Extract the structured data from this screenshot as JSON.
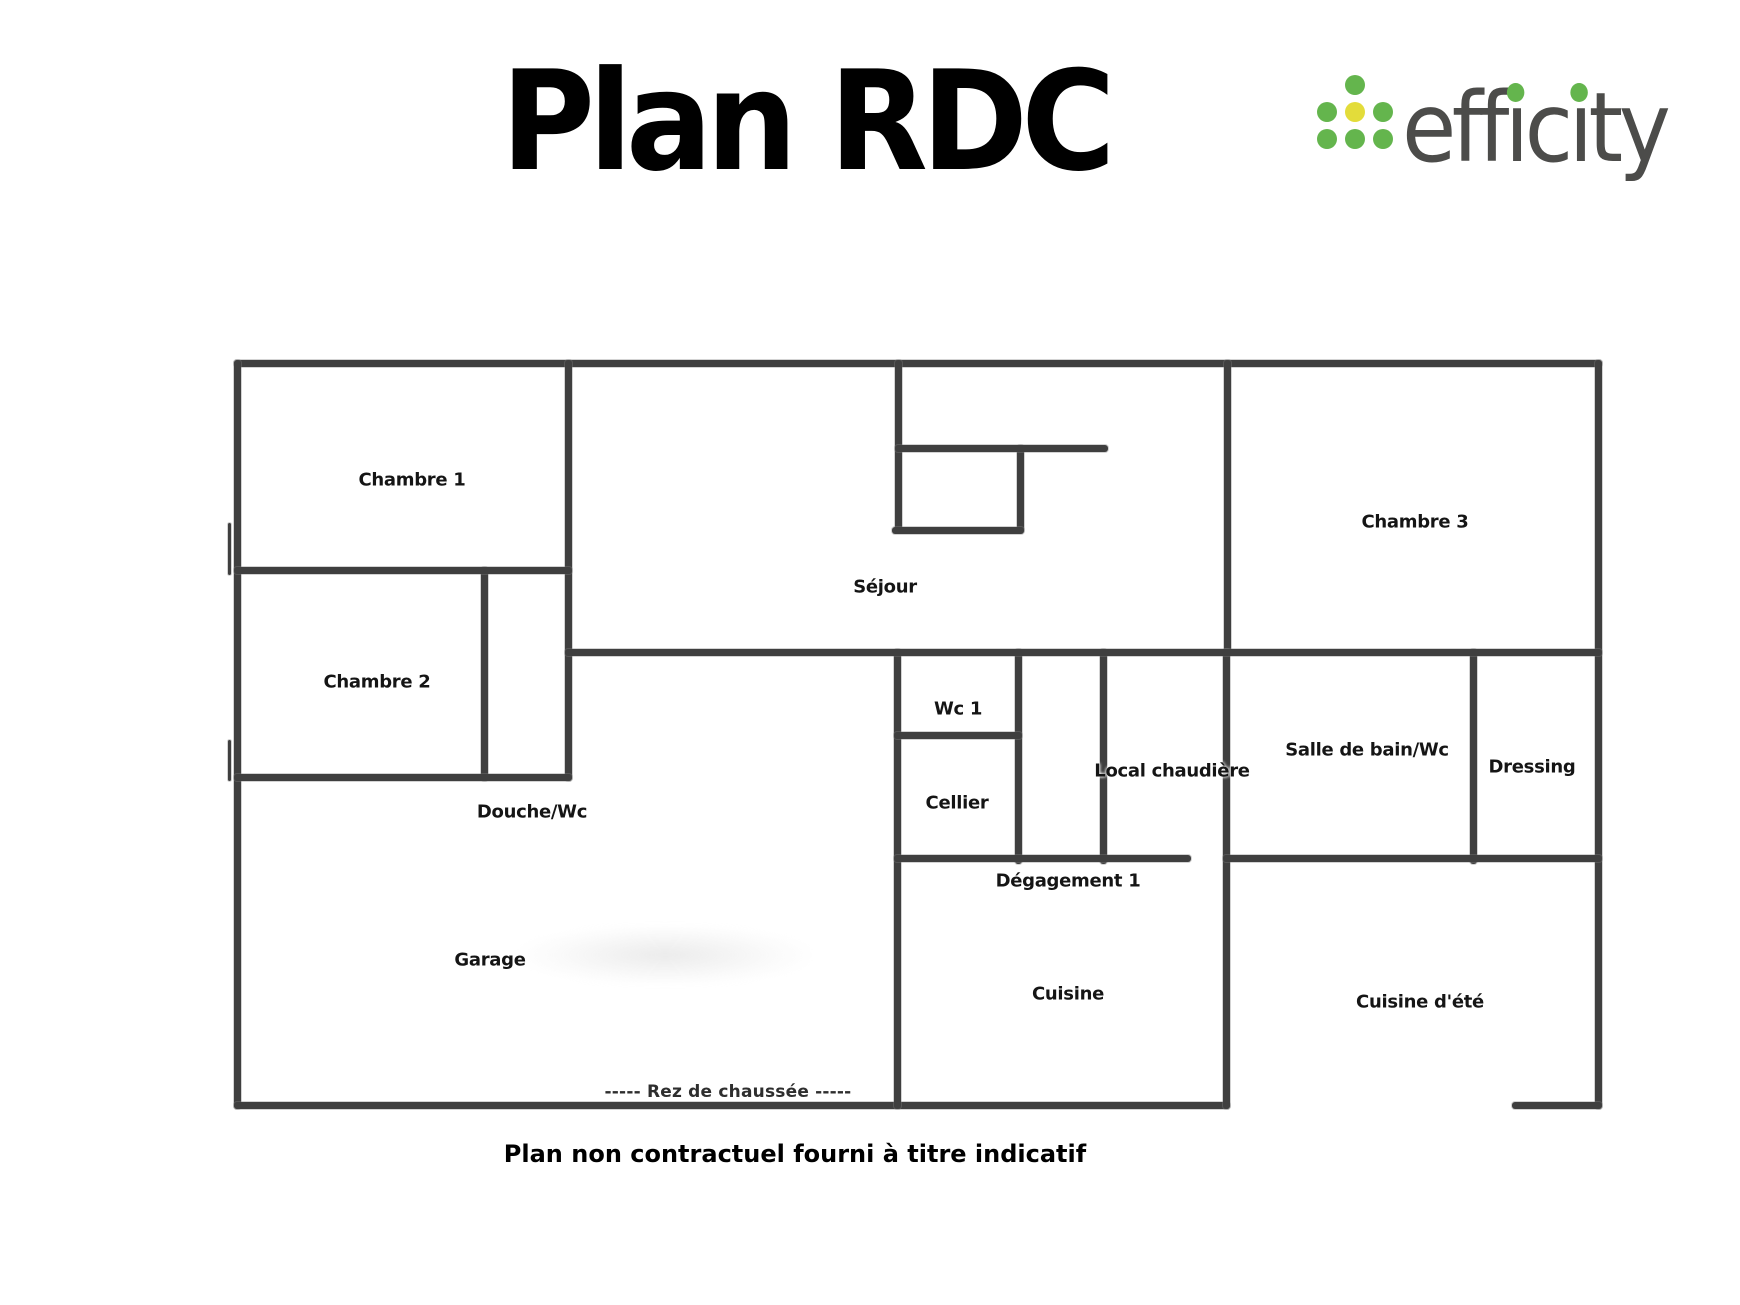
{
  "title": {
    "text": "Plan RDC"
  },
  "logo": {
    "word": "efficity",
    "render_parts": [
      {
        "t": "eff",
        "dot": false
      },
      {
        "t": "ı",
        "dot": true
      },
      {
        "t": "c",
        "dot": false
      },
      {
        "t": "ı",
        "dot": true
      },
      {
        "t": "ty",
        "dot": false
      }
    ],
    "text_color": "#4c4c4a",
    "dot_green": "#64b54d",
    "dot_yellow": "#e3dc3a",
    "pyramid_rows": [
      1,
      3,
      3
    ]
  },
  "floorplan": {
    "wall_color": "#3f3f3f",
    "footer_note": "-----  Rez de chaussée  -----",
    "rooms": [
      {
        "label": "Chambre 1",
        "x": 412,
        "y": 480
      },
      {
        "label": "Chambre 2",
        "x": 377,
        "y": 682
      },
      {
        "label": "Chambre 3",
        "x": 1415,
        "y": 522
      },
      {
        "label": "Séjour",
        "x": 885,
        "y": 587
      },
      {
        "label": "Wc 1",
        "x": 958,
        "y": 709
      },
      {
        "label": "Cellier",
        "x": 957,
        "y": 803
      },
      {
        "label": "Local chaudière",
        "x": 1172,
        "y": 771
      },
      {
        "label": "Salle de bain/Wc",
        "x": 1367,
        "y": 750
      },
      {
        "label": "Dressing",
        "x": 1532,
        "y": 767
      },
      {
        "label": "Douche/Wc",
        "x": 532,
        "y": 812
      },
      {
        "label": "Dégagement 1",
        "x": 1068,
        "y": 881
      },
      {
        "label": "Garage",
        "x": 490,
        "y": 960
      },
      {
        "label": "Cuisine",
        "x": 1068,
        "y": 994
      },
      {
        "label": "Cuisine d'été",
        "x": 1420,
        "y": 1002
      }
    ],
    "walls": [
      {
        "id": "outer-top",
        "x": 234,
        "y": 360,
        "w": 1368,
        "h": 7
      },
      {
        "id": "outer-left",
        "x": 234,
        "y": 360,
        "w": 7,
        "h": 749
      },
      {
        "id": "outer-right",
        "x": 1595,
        "y": 360,
        "w": 7,
        "h": 749
      },
      {
        "id": "bottom-main",
        "x": 234,
        "y": 1102,
        "w": 996,
        "h": 7
      },
      {
        "id": "bottom-right-stub",
        "x": 1512,
        "y": 1102,
        "w": 90,
        "h": 7
      },
      {
        "id": "chambre1-right",
        "x": 565,
        "y": 360,
        "w": 7,
        "h": 421
      },
      {
        "id": "chambre2-right",
        "x": 481,
        "y": 567,
        "w": 7,
        "h": 214
      },
      {
        "id": "alcove-left",
        "x": 895,
        "y": 360,
        "w": 7,
        "h": 173
      },
      {
        "id": "alcove-right",
        "x": 1017,
        "y": 445,
        "w": 7,
        "h": 88
      },
      {
        "id": "sejour-chambre3-divider",
        "x": 1224,
        "y": 360,
        "w": 7,
        "h": 296
      },
      {
        "id": "mid-left-vertical",
        "x": 894,
        "y": 649,
        "w": 7,
        "h": 460
      },
      {
        "id": "wc-cellier-right",
        "x": 1015,
        "y": 649,
        "w": 7,
        "h": 215
      },
      {
        "id": "corridor-right",
        "x": 1100,
        "y": 649,
        "w": 7,
        "h": 215
      },
      {
        "id": "chaufferie-right",
        "x": 1223,
        "y": 649,
        "w": 7,
        "h": 460
      },
      {
        "id": "sdb-dressing-divider",
        "x": 1470,
        "y": 649,
        "w": 7,
        "h": 215
      },
      {
        "id": "chambre1-chambre2-divider",
        "x": 234,
        "y": 567,
        "w": 338,
        "h": 7
      },
      {
        "id": "sejour-bottom",
        "x": 565,
        "y": 649,
        "w": 1037,
        "h": 7
      },
      {
        "id": "alcove-top-stub",
        "x": 895,
        "y": 445,
        "w": 213,
        "h": 7
      },
      {
        "id": "alcove-bottom",
        "x": 892,
        "y": 527,
        "w": 132,
        "h": 7
      },
      {
        "id": "wc-cellier-divider",
        "x": 894,
        "y": 732,
        "w": 128,
        "h": 7
      },
      {
        "id": "chambre2-bottom",
        "x": 234,
        "y": 774,
        "w": 338,
        "h": 7
      },
      {
        "id": "degagement-top",
        "x": 894,
        "y": 855,
        "w": 297,
        "h": 7
      },
      {
        "id": "sdb-dressing-bottom",
        "x": 1223,
        "y": 855,
        "w": 379,
        "h": 7
      },
      {
        "id": "left-notch-upper",
        "x": 228,
        "y": 523,
        "w": 3,
        "h": 52
      },
      {
        "id": "left-notch-lower",
        "x": 228,
        "y": 740,
        "w": 3,
        "h": 41
      }
    ]
  },
  "caption": {
    "text": "Plan non contractuel fourni à titre indicatif"
  }
}
